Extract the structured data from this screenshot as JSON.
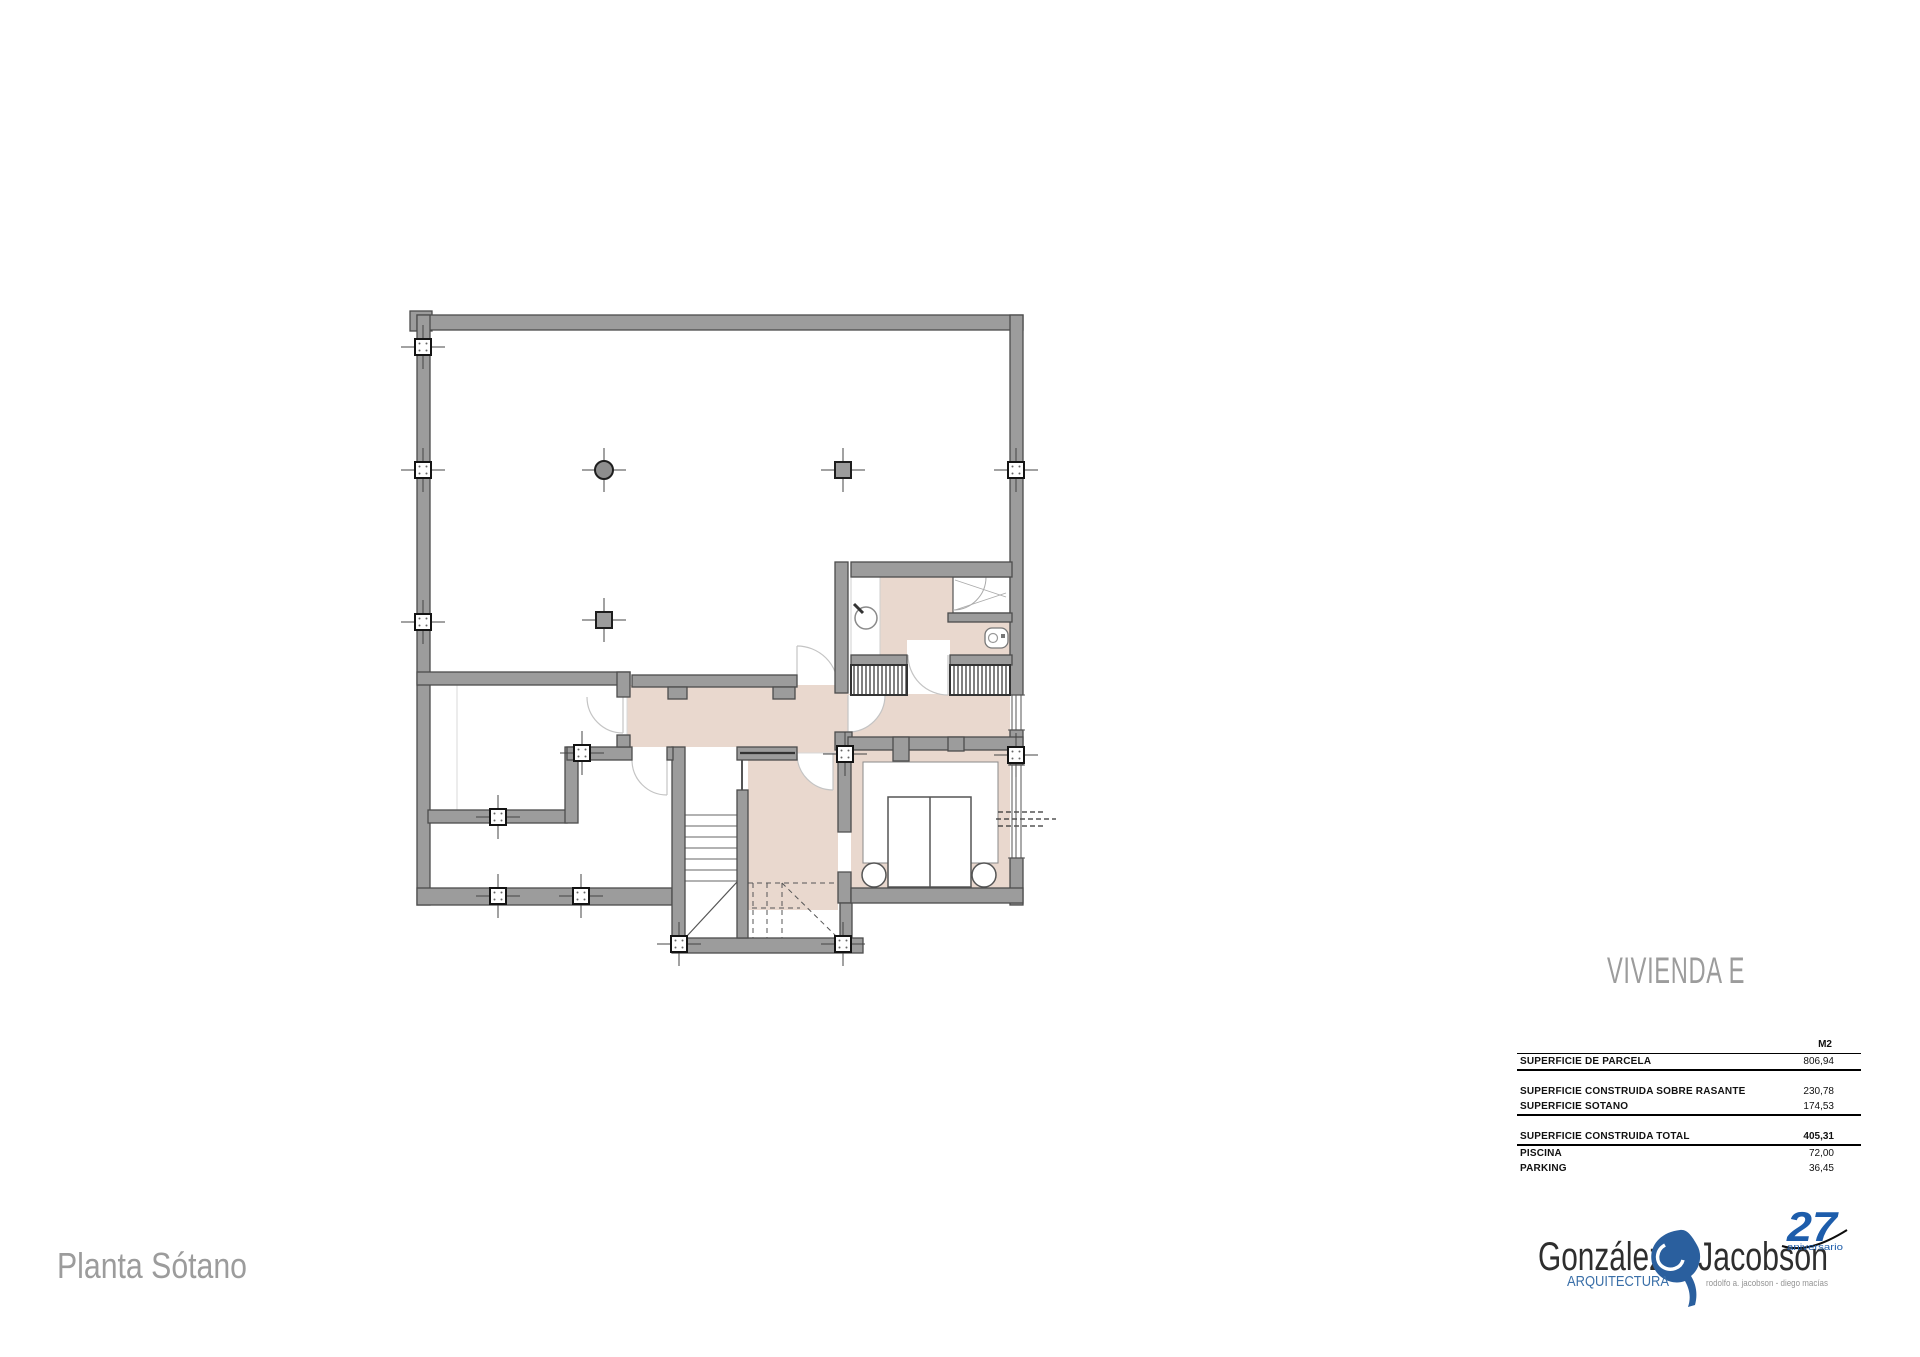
{
  "titles": {
    "project": "VIVIENDA E",
    "plan": "Planta Sótano"
  },
  "area_table": {
    "unit_header": "M2",
    "rows": [
      {
        "label": "SUPERFICIE DE PARCELA",
        "value": "806,94"
      },
      {
        "label": "SUPERFICIE CONSTRUIDA SOBRE RASANTE",
        "value": "230,78"
      },
      {
        "label": "SUPERFICIE SOTANO",
        "value": "174,53"
      },
      {
        "label": "SUPERFICIE CONSTRUIDA TOTAL",
        "value": "405,31"
      },
      {
        "label": "PISCINA",
        "value": "72,00"
      },
      {
        "label": "PARKING",
        "value": "36,45"
      }
    ]
  },
  "logo": {
    "name_first": "González",
    "name_second": "Jacobson",
    "tagline": "ARQUITECTURA",
    "partners": "rodolfo a. jacobson - diego macías",
    "anniversary_number": "27",
    "anniversary_word": "aniversario"
  },
  "colors": {
    "wall_gray": "#9c9c9c",
    "wall_outline": "#4c4c4c",
    "floor_pink": "#e9d8ce",
    "title_gray": "#9c9c9c",
    "logo_blue": "#2a5f9e",
    "logo_dark": "#2e2e2e"
  }
}
